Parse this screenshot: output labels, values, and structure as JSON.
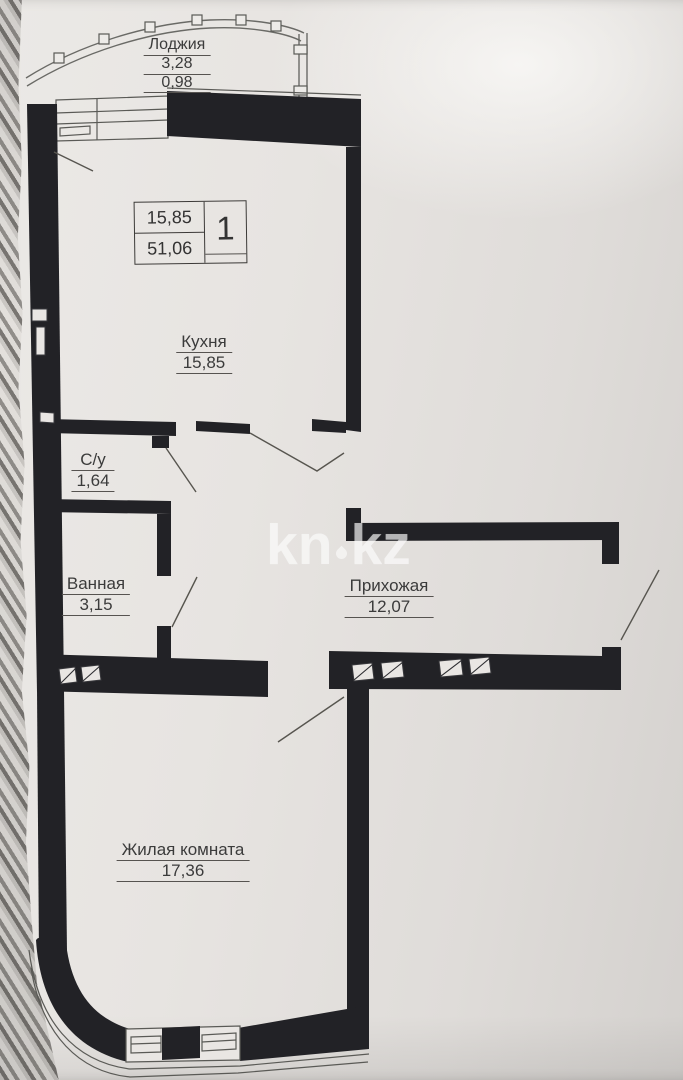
{
  "plan": {
    "stamp": {
      "living_area": "15,85",
      "total_area": "51,06",
      "room_count": "1"
    },
    "rooms": [
      {
        "name": "Лоджия",
        "area": "3,28",
        "area_reduced": "0,98"
      },
      {
        "name": "Кухня",
        "area": "15,85"
      },
      {
        "name": "С/у",
        "area": "1,64"
      },
      {
        "name": "Ванная",
        "area": "3,15"
      },
      {
        "name": "Прихожая",
        "area": "12,07"
      },
      {
        "name": "Жилая комната",
        "area": "17,36"
      }
    ],
    "watermark": {
      "left": "kn",
      "right": "kz"
    }
  },
  "colors": {
    "wall": "#222226",
    "thin_line": "#55544f",
    "label_text": "#3b3b3b",
    "paper": "#e7e4e1",
    "watermark": "rgba(252,252,251,0.62)"
  }
}
